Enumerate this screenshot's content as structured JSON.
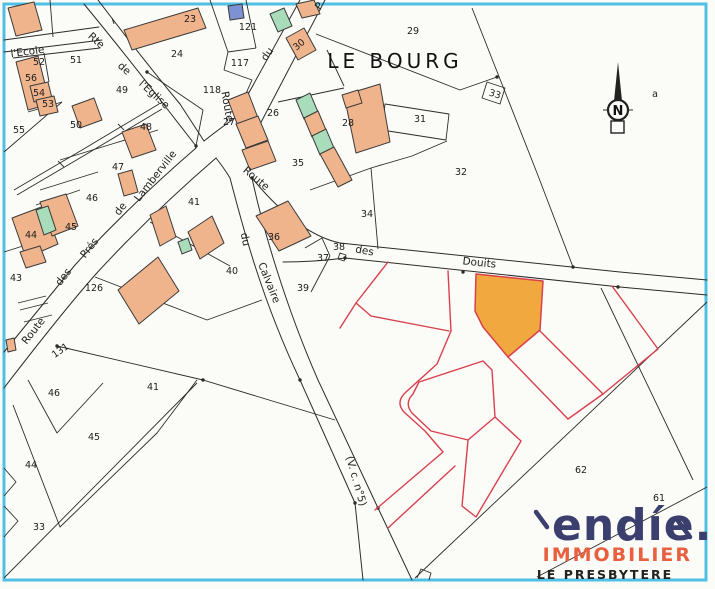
{
  "map": {
    "title_area": "LE BOURG",
    "bottom_area": "LE PRESBYTERE",
    "north_letter": "N",
    "corner_note": "a",
    "boxed_parcel": "33",
    "logo": {
      "word": "endíe.",
      "tagline": "IMMOBILIER"
    },
    "colors": {
      "border": "#4FC0E4",
      "parcel_line": "#2B2B2B",
      "subdivision_line": "#D8404E",
      "building_fill": "#EFB48C",
      "building_green": "#A9DCBB",
      "building_blue": "#7D92D2",
      "highlight_lot": "#F1A93F",
      "logo_navy": "#3B3F6D",
      "logo_coral": "#E8603F"
    },
    "road_labels": [
      {
        "t": "l'Ecole",
        "x": 28,
        "y": 55,
        "r": -8
      },
      {
        "t": "Rte",
        "x": 94,
        "y": 43,
        "r": 42
      },
      {
        "t": "de",
        "x": 122,
        "y": 71,
        "r": 42
      },
      {
        "t": "l'Eglise",
        "x": 152,
        "y": 97,
        "r": 42
      },
      {
        "t": "Route",
        "x": 224,
        "y": 107,
        "r": 80
      },
      {
        "t": "du",
        "x": 270,
        "y": 56,
        "r": -55
      },
      {
        "t": "P",
        "x": 322,
        "y": 8,
        "r": -55
      },
      {
        "t": "Route",
        "x": 254,
        "y": 181,
        "r": 40
      },
      {
        "t": "des",
        "x": 364,
        "y": 254,
        "r": 10
      },
      {
        "t": "Douits",
        "x": 479,
        "y": 266,
        "r": 6
      },
      {
        "t": "du",
        "x": 242,
        "y": 240,
        "r": 78
      },
      {
        "t": "Calvaire",
        "x": 266,
        "y": 284,
        "r": 68
      },
      {
        "t": "(V. c. n°5)",
        "x": 353,
        "y": 482,
        "r": 74
      },
      {
        "t": "Route",
        "x": 36,
        "y": 333,
        "r": -52
      },
      {
        "t": "des",
        "x": 66,
        "y": 279,
        "r": -52
      },
      {
        "t": "Prés",
        "x": 92,
        "y": 250,
        "r": -52
      },
      {
        "t": "de",
        "x": 123,
        "y": 211,
        "r": -52
      },
      {
        "t": "Lamberville",
        "x": 158,
        "y": 178,
        "r": -52
      }
    ],
    "parcel_labels": [
      {
        "t": "23",
        "x": 190,
        "y": 22
      },
      {
        "t": "24",
        "x": 177,
        "y": 57
      },
      {
        "t": "121",
        "x": 248,
        "y": 30
      },
      {
        "t": "117",
        "x": 240,
        "y": 66
      },
      {
        "t": "118",
        "x": 212,
        "y": 93
      },
      {
        "t": "29",
        "x": 413,
        "y": 34
      },
      {
        "t": "30",
        "x": 301,
        "y": 47,
        "r": -40
      },
      {
        "t": "27",
        "x": 229,
        "y": 125
      },
      {
        "t": "26",
        "x": 273,
        "y": 116
      },
      {
        "t": "28",
        "x": 348,
        "y": 126
      },
      {
        "t": "31",
        "x": 420,
        "y": 122
      },
      {
        "t": "32",
        "x": 461,
        "y": 175
      },
      {
        "t": "35",
        "x": 298,
        "y": 166
      },
      {
        "t": "34",
        "x": 367,
        "y": 217
      },
      {
        "t": "36",
        "x": 274,
        "y": 240
      },
      {
        "t": "37",
        "x": 323,
        "y": 261
      },
      {
        "t": "38",
        "x": 339,
        "y": 250
      },
      {
        "t": "39",
        "x": 303,
        "y": 291
      },
      {
        "t": "40",
        "x": 232,
        "y": 274
      },
      {
        "t": "41",
        "x": 194,
        "y": 205
      },
      {
        "t": "43",
        "x": 16,
        "y": 281
      },
      {
        "t": "44",
        "x": 31,
        "y": 238
      },
      {
        "t": "126",
        "x": 94,
        "y": 291
      },
      {
        "t": "131",
        "x": 62,
        "y": 353,
        "r": -35
      },
      {
        "t": "46",
        "x": 92,
        "y": 201
      },
      {
        "t": "45",
        "x": 71,
        "y": 230
      },
      {
        "t": "47",
        "x": 118,
        "y": 170
      },
      {
        "t": "48",
        "x": 146,
        "y": 130
      },
      {
        "t": "49",
        "x": 122,
        "y": 93
      },
      {
        "t": "50",
        "x": 76,
        "y": 128
      },
      {
        "t": "51",
        "x": 76,
        "y": 63
      },
      {
        "t": "52",
        "x": 39,
        "y": 65
      },
      {
        "t": "53",
        "x": 48,
        "y": 107
      },
      {
        "t": "54",
        "x": 39,
        "y": 96
      },
      {
        "t": "55",
        "x": 19,
        "y": 133
      },
      {
        "t": "56",
        "x": 31,
        "y": 81
      },
      {
        "t": "62",
        "x": 581,
        "y": 473
      },
      {
        "t": "61",
        "x": 659,
        "y": 501
      },
      {
        "t": "a",
        "x": 655,
        "y": 97
      },
      {
        "t": "46",
        "x": 54,
        "y": 396
      },
      {
        "t": "41",
        "x": 153,
        "y": 390
      },
      {
        "t": "45",
        "x": 94,
        "y": 440
      },
      {
        "t": "44",
        "x": 31,
        "y": 468
      },
      {
        "t": "33",
        "x": 39,
        "y": 530
      }
    ]
  }
}
